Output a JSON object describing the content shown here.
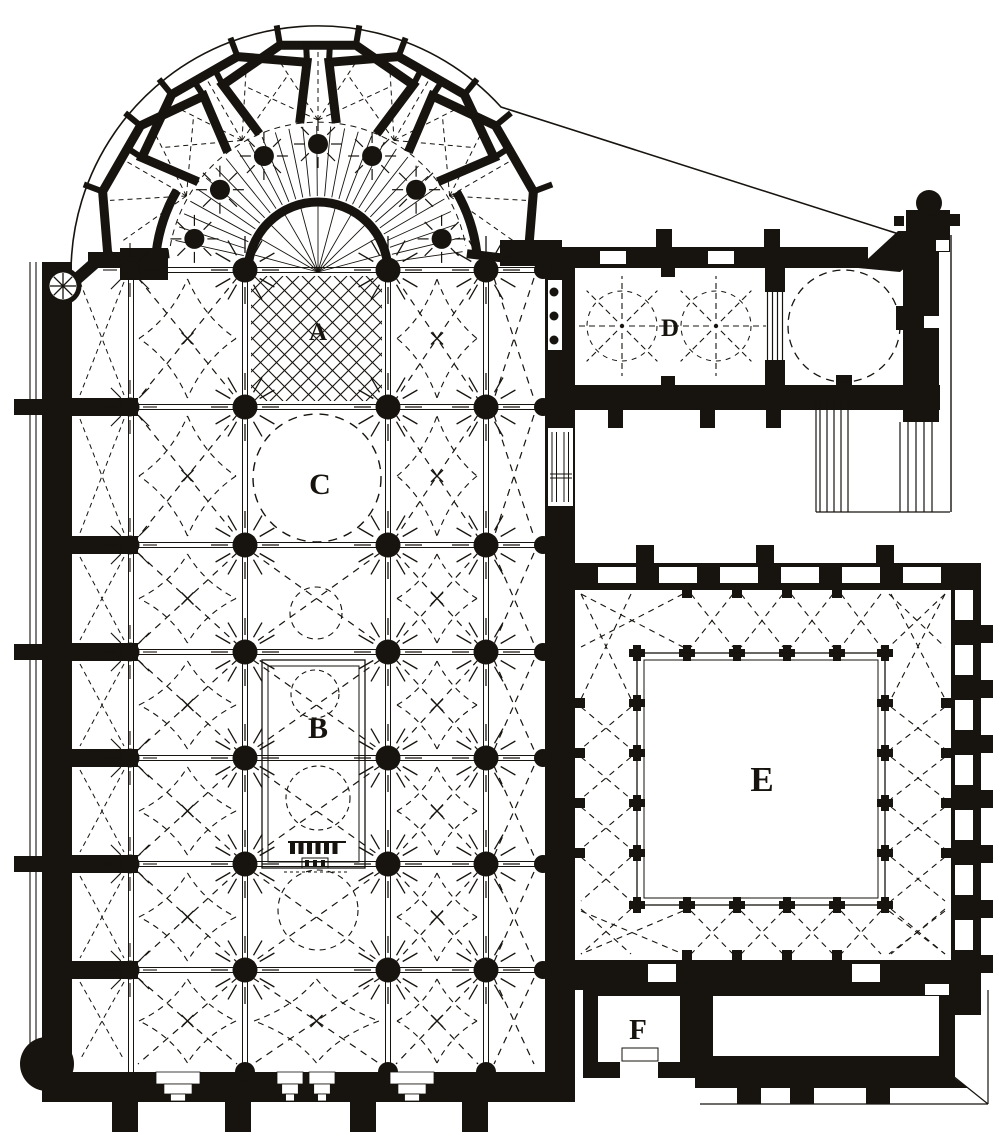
{
  "plan": {
    "figure_type": "engraved gothic cathedral floor plan",
    "ink": "#17130e",
    "paper": "#ffffff",
    "labels": [
      {
        "id": "A",
        "text": "A"
      },
      {
        "id": "B",
        "text": "B"
      },
      {
        "id": "C",
        "text": "C"
      },
      {
        "id": "D",
        "text": "D"
      },
      {
        "id": "E",
        "text": "E"
      },
      {
        "id": "F",
        "text": "F"
      }
    ]
  }
}
